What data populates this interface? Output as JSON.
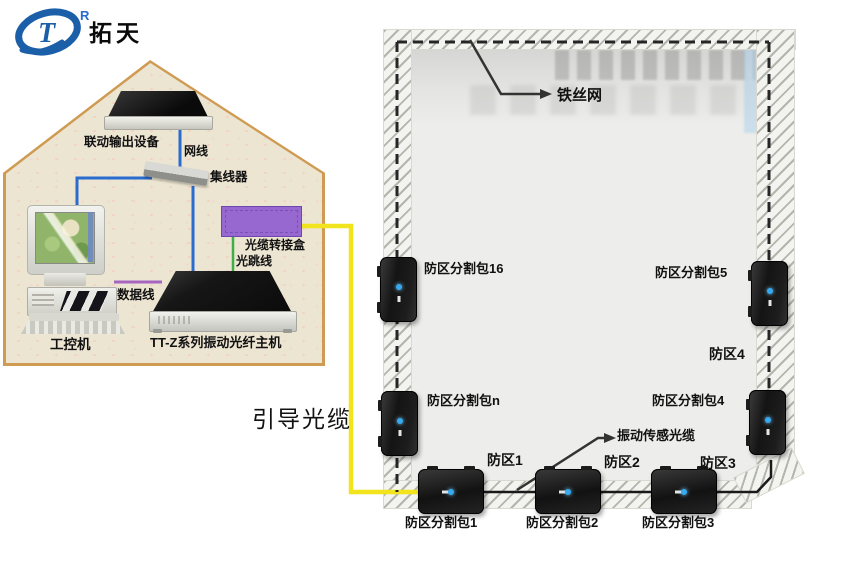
{
  "logo": {
    "brand_text": "拓天",
    "registered_mark": "R"
  },
  "house": {
    "labels": {
      "linkage_device": "联动输出设备",
      "network_cable": "网线",
      "hub": "集线器",
      "junction_box": "光缆转接盒",
      "fiber_jumper": "光跳线",
      "data_cable": "数据线",
      "industrial_pc": "工控机",
      "host": "TT-Z系列振动光纤主机"
    }
  },
  "cables": {
    "guide_cable_label": "引导光缆"
  },
  "fence": {
    "wire_mesh_label": "铁丝网",
    "sensing_cable_label": "振动传感光缆",
    "packages": [
      {
        "id": "16",
        "label": "防区分割包16"
      },
      {
        "id": "5",
        "label": "防区分割包5"
      },
      {
        "id": "n",
        "label": "防区分割包n"
      },
      {
        "id": "4",
        "label": "防区分割包4"
      },
      {
        "id": "1",
        "label": "防区分割包1"
      },
      {
        "id": "2",
        "label": "防区分割包2"
      },
      {
        "id": "3",
        "label": "防区分割包3"
      }
    ],
    "zones": [
      {
        "label": "防区4"
      },
      {
        "label": "防区1"
      },
      {
        "label": "防区2"
      },
      {
        "label": "防区3"
      }
    ]
  },
  "colors": {
    "guide_cable": "#f2e41c",
    "network_line": "#2a6bd0",
    "fiber_jumper_line": "#3fae49",
    "data_line": "#a565c0",
    "junction_box": "#9768cf",
    "sensing_cable": "#262626",
    "led": "#35aaf0",
    "house_border": "#cf9a52",
    "house_fill": "#ece5d2",
    "logo_blue": "#1a5fa8"
  }
}
